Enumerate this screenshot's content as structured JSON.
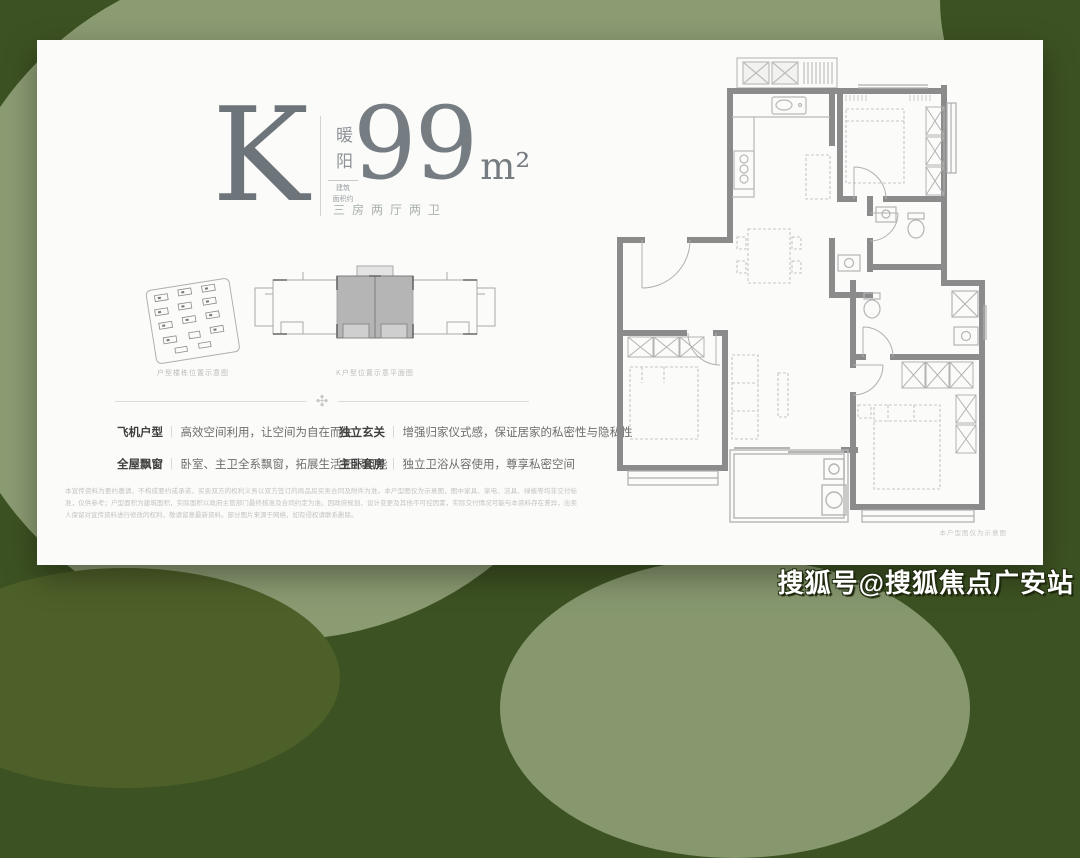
{
  "card": {
    "unit_letter": "K",
    "series_name": "暖阳",
    "area_prefix_line1": "建筑",
    "area_prefix_line2": "面积约",
    "area_value": "99",
    "area_unit": "m²",
    "layout_desc": "三房两厅两卫",
    "site_caption": "户型楼栋位置示意图",
    "plate_caption": "K户型位置示意平面图",
    "features": [
      {
        "label": "飞机户型",
        "text": "高效空间利用，让空间为自在而生"
      },
      {
        "label": "全屋飘窗",
        "text": "卧室、主卫全系飘窗，拓展生活无限可能"
      },
      {
        "label": "独立玄关",
        "text": "增强归家仪式感，保证居家的私密性与隐私性"
      },
      {
        "label": "主卧套房",
        "text": "独立卫浴从容使用，尊享私密空间"
      }
    ],
    "disclaimer": "本宣传资料为要约邀请，不构成要约或承诺，买卖双方的权利义务以双方签订的商品房买卖合同及附件为准。本户型图仅为示意图，图中家具、家电、洁具、绿植等均非交付标准，仅供参考；户型面积为建筑面积，实际面积以政府主管部门最终核准及合同约定为准。因政府规划、设计变更及其他不可控因素，实际交付情况可能与本资料存在差异，出卖人保留对宣传资料进行修改的权利，敬请留意最新资料。部分图片来源于网络，如有侵权请联系删除。",
    "plan_caption": "本户型图仅为示意图"
  },
  "watermark": "搜狐号@搜狐焦点广安站",
  "colors": {
    "background_dark_green": "#3d5222",
    "background_sage": "#8b9b72",
    "card_background": "#fbfbf9",
    "headline_gray": "#6e757a",
    "wall_gray": "#8b8b8b"
  }
}
